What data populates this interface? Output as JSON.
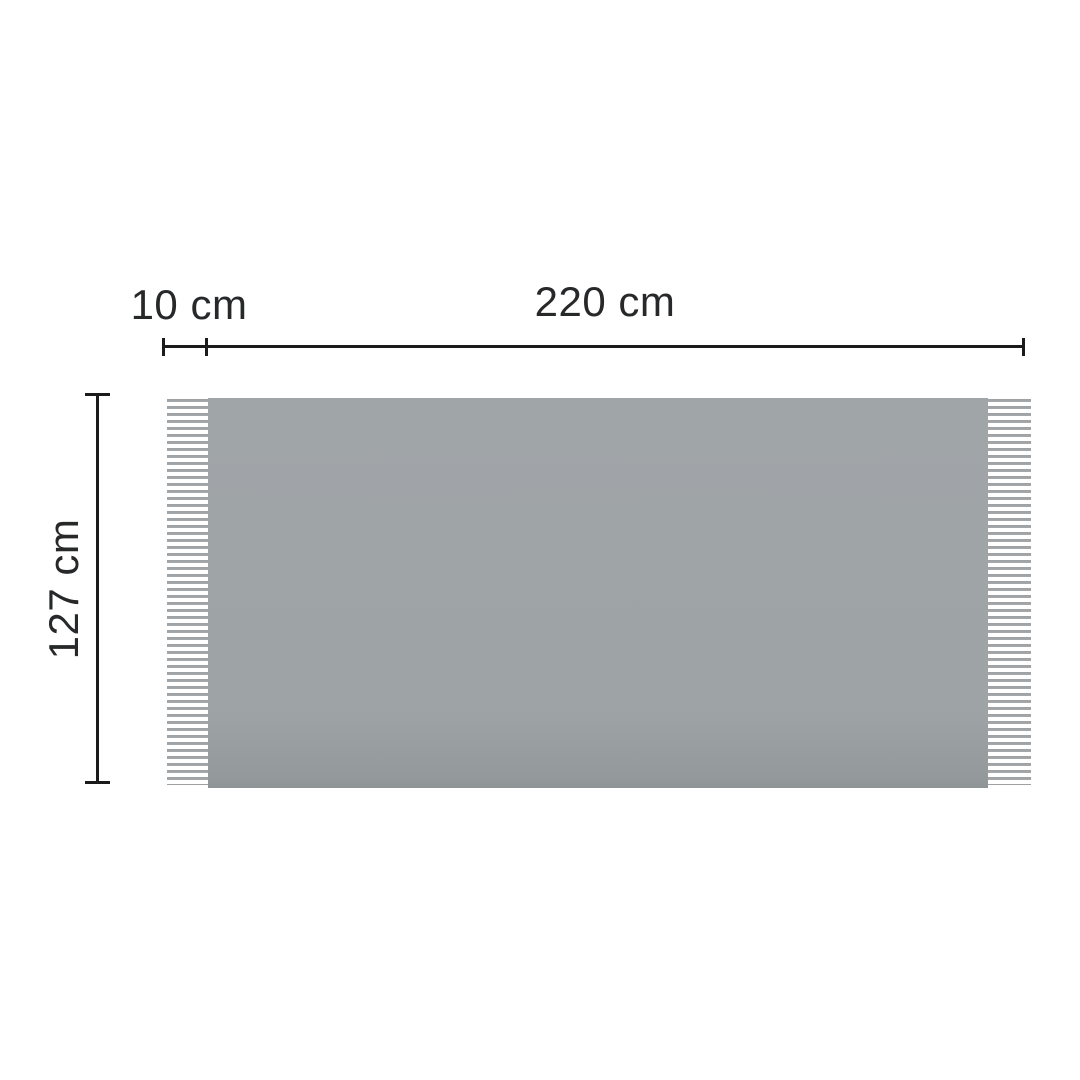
{
  "diagram": {
    "kind": "blanket-dimension-diagram",
    "labels": {
      "fringe_width": "10 cm",
      "total_width": "220 cm",
      "height": "127 cm"
    },
    "values": {
      "fringe_width_cm": 10,
      "total_width_cm": 220,
      "height_cm": 127,
      "unit": "cm"
    },
    "colors": {
      "background": "#ffffff",
      "blanket_body": "#9ea3a6",
      "fringe_stripe": "#a2a6a9",
      "dimension_line": "#1b1b1b",
      "label_text": "#26282a"
    }
  }
}
